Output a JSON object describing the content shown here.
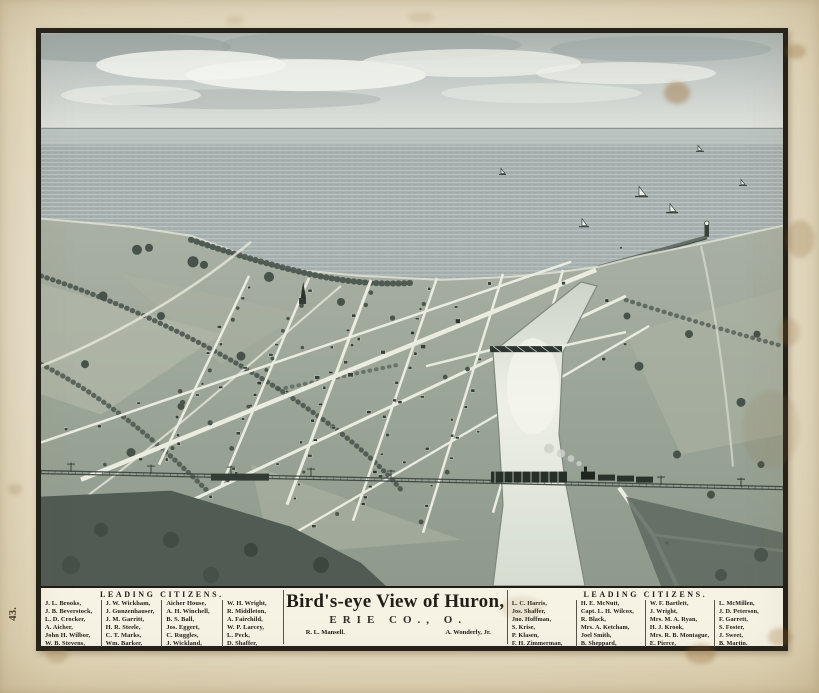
{
  "margin": {
    "page_number": "43."
  },
  "banner": {
    "left_citizens": {
      "heading": "LEADING CITIZENS.",
      "columns": [
        [
          "J. L. Brooks,",
          "J. B. Beverstock,",
          "L. D. Crocker,",
          "A. Aicher,",
          "John H. Wilbor,",
          "W. B. Stevens,"
        ],
        [
          "J. W. Wickham,",
          "J. Gunzenhauser,",
          "J. M. Garritt,",
          "H. R. Steele,",
          "C. T. Marks,",
          "Wm. Barker,"
        ],
        [
          "Aicher House,",
          "A. H. Winchell,",
          "B. S. Ball,",
          "Jos. Eggert,",
          "C. Ruggles,",
          "J. Wickland,"
        ],
        [
          "W. H. Wright,",
          "R. Middleton,",
          "A. Fairchild,",
          "W. P. Larcey,",
          "L. Peck,",
          "D. Shaffer,"
        ]
      ]
    },
    "title_block": {
      "title": "Bird's-eye View of Huron,",
      "subtitle": "ERIE CO., O.",
      "credit_left": "R. L. Mansell.",
      "credit_right": "A. Wonderly, Jr."
    },
    "right_citizens": {
      "heading": "LEADING CITIZENS.",
      "columns": [
        [
          "L. C. Harris,",
          "Jos. Shaffer,",
          "Jno. Hoffman,",
          "S. Krise,",
          "P. Klasen,",
          "F. H. Zimmerman,"
        ],
        [
          "H. E. McNutt,",
          "Capt. L. H. Wilcox,",
          "R. Black,",
          "Mrs. A. Ketcham,",
          "Joel Smith,",
          "B. Sheppard,"
        ],
        [
          "W. F. Bartlett,",
          "J. Wright,",
          "Mrs. M. A. Ryan,",
          "H. J. Krook,",
          "Mrs. R. B. Montague,",
          "E. Pierce,"
        ],
        [
          "L. McMillen,",
          "J. D. Peterson,",
          "F. Garrett,",
          "S. Foster,",
          "J. Sweet,",
          "B. Martin."
        ]
      ]
    }
  },
  "colors": {
    "paper": "#e9e1ca",
    "frame_ink": "#22201a",
    "print_ink": "#39423b",
    "water": "#a7b1b0",
    "stain_brown": "#996427"
  }
}
